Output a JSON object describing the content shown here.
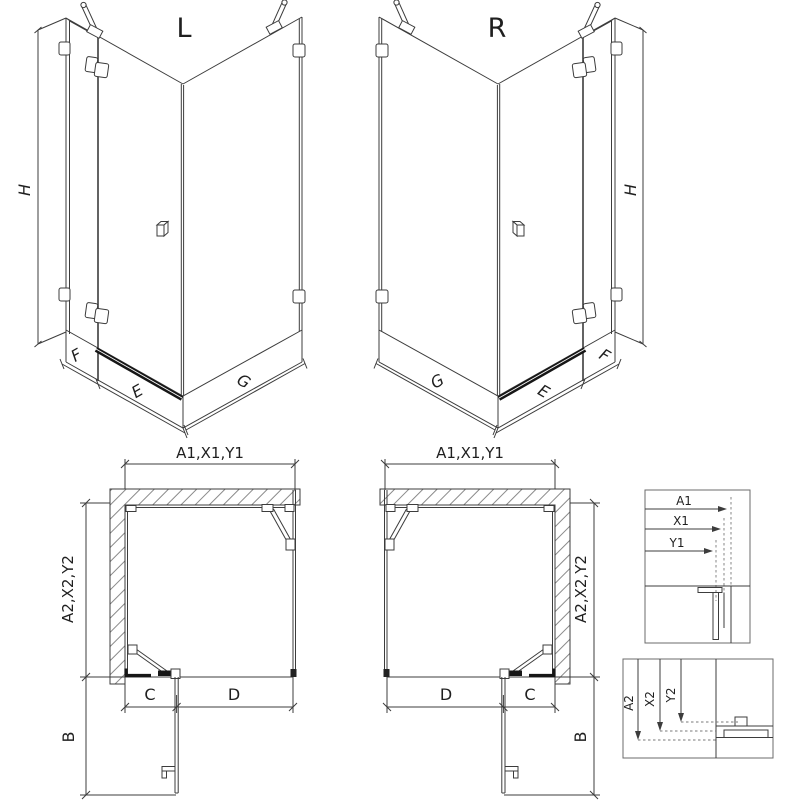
{
  "drawing": {
    "iso_left": {
      "title": "L",
      "height": "H",
      "segment_fixed": "F",
      "segment_door": "E",
      "segment_side": "G"
    },
    "iso_right": {
      "title": "R",
      "height": "H",
      "segment_fixed": "F",
      "segment_door": "E",
      "segment_side": "G"
    },
    "plan_left": {
      "width": "A1,X1,Y1",
      "depth": "A2,X2,Y2",
      "c": "C",
      "d": "D",
      "b": "B"
    },
    "plan_right": {
      "width": "A1,X1,Y1",
      "depth": "A2,X2,Y2",
      "c": "C",
      "d": "D",
      "b": "B"
    },
    "legend_width": {
      "a1": "A1",
      "x1": "X1",
      "y1": "Y1"
    },
    "legend_depth": {
      "a2": "A2",
      "x2": "X2",
      "y2": "Y2"
    },
    "colors": {
      "line": "#3c3c3c",
      "dark": "#161616",
      "hatch": "#8a8a8a",
      "box_border": "#6b6b6b",
      "background": "#ffffff",
      "text": "#1f1f1f"
    }
  }
}
